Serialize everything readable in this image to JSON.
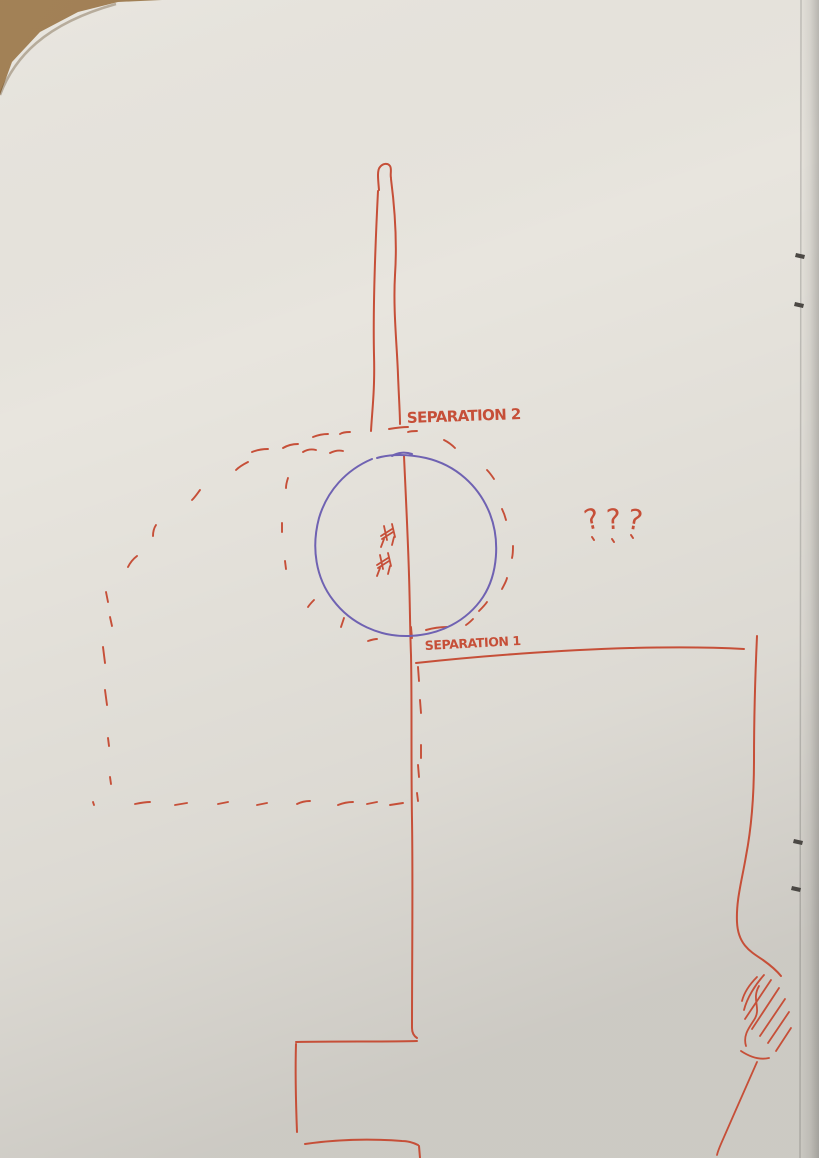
{
  "photo": {
    "labels": {
      "separation_2": "SEPARATION 2",
      "separation_1": "SEPARATION 1",
      "question_marks": "???"
    },
    "colors": {
      "red_ink": "#c64f38",
      "blue_ink": "#6f62b2",
      "paper": "#e8e5de",
      "wood": "#96703f",
      "staple": "#4b4844"
    }
  }
}
